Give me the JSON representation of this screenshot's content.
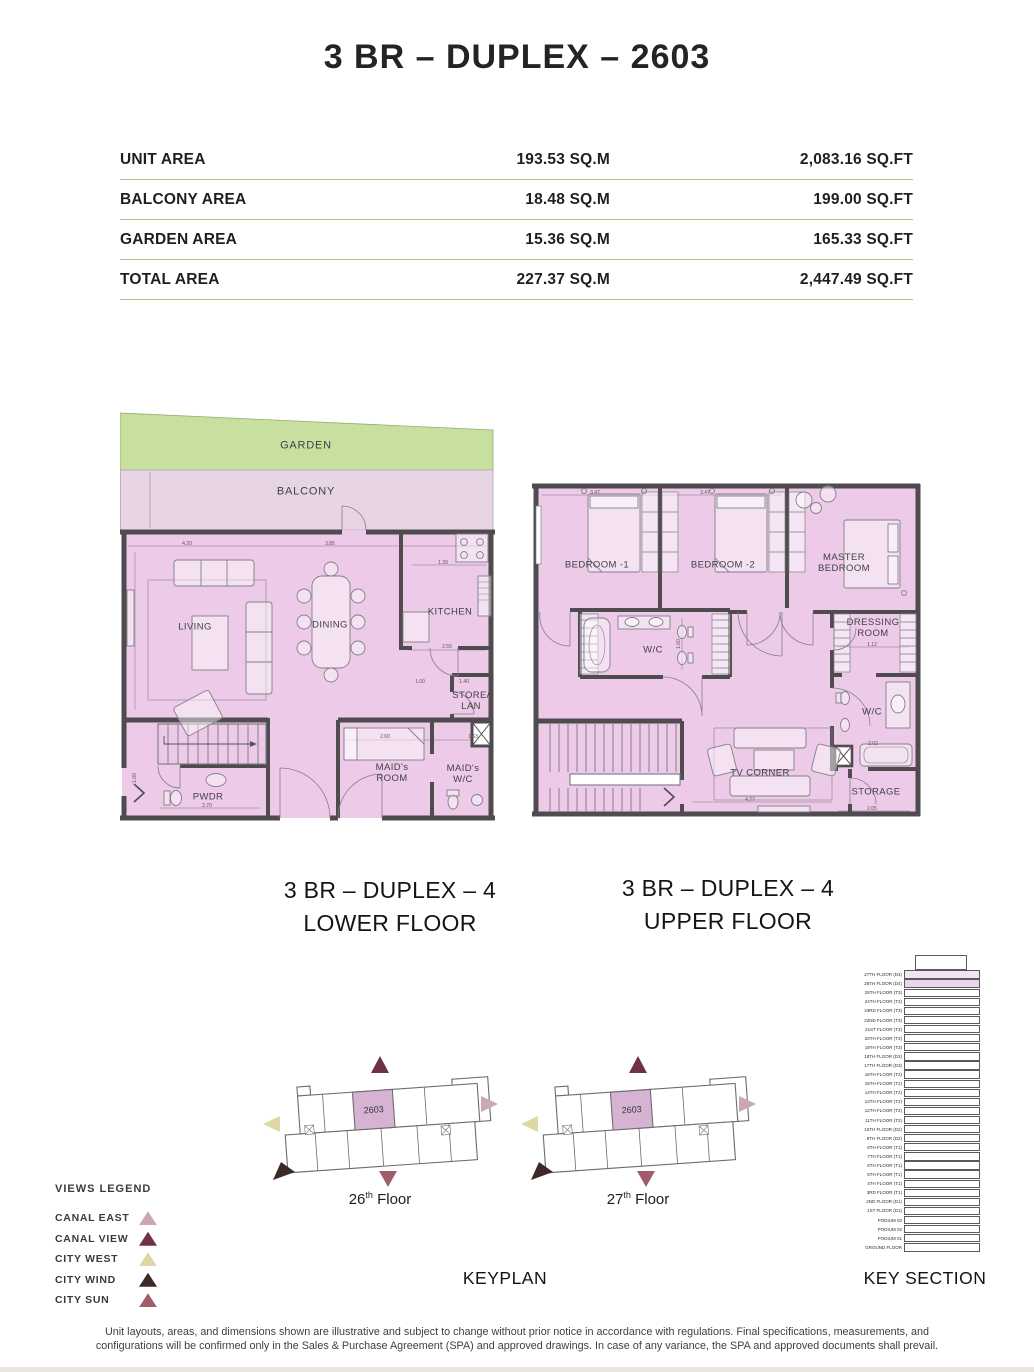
{
  "page": {
    "title": "3 BR – DUPLEX – 2603",
    "keyplan_label": "KEYPLAN",
    "key_section_label": "KEY SECTION",
    "disclaimer_line1": "Unit layouts, areas, and dimensions shown are illustrative and subject to change without prior notice in accordance with regulations. Final specifications, measurements, and",
    "disclaimer_line2": "configurations will be confirmed only in the Sales & Purchase Agreement (SPA) and approved drawings. In case of any variance, the SPA and approved documents shall prevail."
  },
  "area_table": {
    "rows": [
      {
        "label": "UNIT AREA",
        "sqm": "193.53 SQ.M",
        "sqft": "2,083.16 SQ.FT"
      },
      {
        "label": "BALCONY AREA",
        "sqm": "18.48 SQ.M",
        "sqft": "199.00 SQ.FT"
      },
      {
        "label": "GARDEN AREA",
        "sqm": "15.36 SQ.M",
        "sqft": "165.33 SQ.FT"
      },
      {
        "label": "TOTAL AREA",
        "sqm": "227.37 SQ.M",
        "sqft": "2,447.49 SQ.FT"
      }
    ]
  },
  "lower_plan": {
    "caption_line1": "3 BR – DUPLEX – 4",
    "caption_line2": "LOWER FLOOR",
    "labels": {
      "garden": "GARDEN",
      "balcony": "BALCONY",
      "living": "LIVING",
      "dining": "DINING",
      "kitchen": "KITCHEN",
      "store_lan": "STORE/ LAN",
      "maids_room": "MAID's ROOM",
      "maids_wc": "MAID's W/C",
      "pwdr": "PWDR"
    },
    "dimensions": [
      {
        "t": "4.20",
        "x": 67,
        "y": 134
      },
      {
        "t": "3.85",
        "x": 210,
        "y": 134
      },
      {
        "t": "1.30",
        "x": 323,
        "y": 153
      },
      {
        "t": "2.55",
        "x": 327,
        "y": 237
      },
      {
        "t": "1.00",
        "x": 300,
        "y": 272
      },
      {
        "t": "1.40",
        "x": 344,
        "y": 272
      },
      {
        "t": "2.60",
        "x": 265,
        "y": 327
      },
      {
        "t": "1.63",
        "x": 353,
        "y": 327
      },
      {
        "t": "2.70",
        "x": 87,
        "y": 396
      },
      {
        "t": "1.00",
        "x": 15,
        "y": 368,
        "r": 1
      }
    ]
  },
  "upper_plan": {
    "caption_line1": "3 BR – DUPLEX – 4",
    "caption_line2": "UPPER FLOOR",
    "labels": {
      "bedroom1": "BEDROOM -1",
      "bedroom2": "BEDROOM -2",
      "master_bedroom": "MASTER BEDROOM",
      "wc_middle": "W/C",
      "dressing_room": "DRESSING ROOM",
      "wc_right": "W/C",
      "tv_corner": "TV CORNER",
      "storage": "STORAGE"
    },
    "dimensions": [
      {
        "t": "3.47",
        "x": 63,
        "y": 15
      },
      {
        "t": "3.47",
        "x": 173,
        "y": 15
      },
      {
        "t": "1.12",
        "x": 340,
        "y": 167
      },
      {
        "t": "1.60",
        "x": 147,
        "y": 166,
        "r": 1
      },
      {
        "t": "2.02",
        "x": 341,
        "y": 266
      },
      {
        "t": "4.77",
        "x": 218,
        "y": 322
      },
      {
        "t": "2.05",
        "x": 340,
        "y": 331
      }
    ]
  },
  "keyplans": [
    {
      "unit": "2603",
      "floor_number": "26",
      "floor_suffix": "th",
      "floor_word": "Floor"
    },
    {
      "unit": "2603",
      "floor_number": "27",
      "floor_suffix": "th",
      "floor_word": "Floor"
    }
  ],
  "views_legend": {
    "title": "VIEWS LEGEND",
    "items": [
      {
        "label": "CANAL EAST",
        "color": "#cda6b6"
      },
      {
        "label": "CANAL VIEW",
        "color": "#6f3343"
      },
      {
        "label": "CITY WEST",
        "color": "#ded9a4"
      },
      {
        "label": "CITY WIND",
        "color": "#3b2a28"
      },
      {
        "label": "CITY SUN",
        "color": "#a25c69"
      }
    ]
  },
  "key_section": {
    "floors": [
      {
        "label": "27TH FLOOR (D4)",
        "highlight": true
      },
      {
        "label": "26TH FLOOR (D4)",
        "highlight": true
      },
      {
        "label": "25TH FLOOR (T3)"
      },
      {
        "label": "24TH FLOOR (T3)"
      },
      {
        "label": "23RD FLOOR (T3)"
      },
      {
        "label": "22ND FLOOR (T3)"
      },
      {
        "label": "21ST FLOOR (T3)"
      },
      {
        "label": "20TH FLOOR (T3)"
      },
      {
        "label": "19TH FLOOR (T3)"
      },
      {
        "label": "18TH FLOOR (D3)"
      },
      {
        "label": "17TH FLOOR (D3)"
      },
      {
        "label": "16TH FLOOR (T2)"
      },
      {
        "label": "15TH FLOOR (T2)"
      },
      {
        "label": "14TH FLOOR (T2)"
      },
      {
        "label": "13TH FLOOR (T2)"
      },
      {
        "label": "12TH FLOOR (T2)"
      },
      {
        "label": "11TH FLOOR (T2)"
      },
      {
        "label": "10TH FLOOR (D2)"
      },
      {
        "label": "9TH FLOOR (D2)"
      },
      {
        "label": "8TH FLOOR (T1)"
      },
      {
        "label": "7TH FLOOR (T1)"
      },
      {
        "label": "6TH FLOOR (T1)"
      },
      {
        "label": "5TH FLOOR (T1)"
      },
      {
        "label": "4TH FLOOR (T1)"
      },
      {
        "label": "3RD FLOOR (T1)"
      },
      {
        "label": "2ND FLOOR (D1)"
      },
      {
        "label": "1ST FLOOR (D1)"
      },
      {
        "label": "PODIUM 03"
      },
      {
        "label": "PODIUM 02"
      },
      {
        "label": "PODIUM 01"
      },
      {
        "label": "GROUND FLOOR"
      }
    ]
  },
  "colors": {
    "plan_fill": "#eccae8",
    "balcony_fill": "#e7d5e4",
    "garden_fill": "#c7e0a0",
    "wall": "#4f4b4e",
    "table_divider": "#c9b18c",
    "keyplan_unit_fill": "#d7b3d3",
    "key_section_highlight_1": "#f3e4f4",
    "key_section_highlight_2": "#edd4ee"
  }
}
